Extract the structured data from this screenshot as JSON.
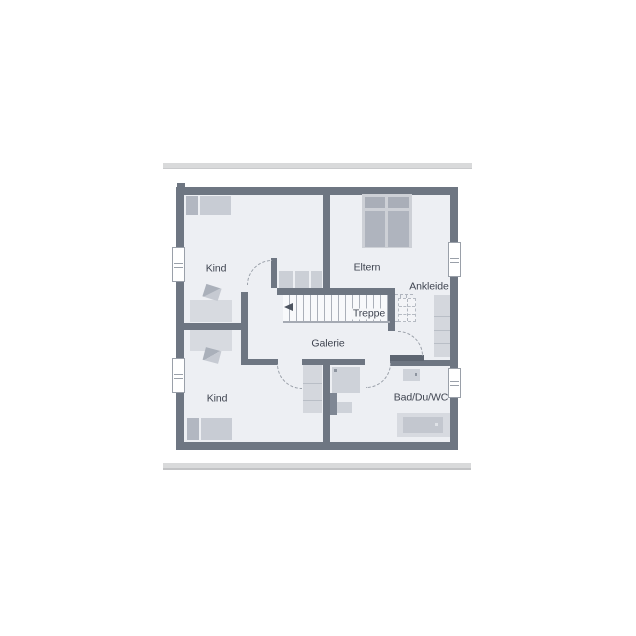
{
  "labels": {
    "kind_top": "Kind",
    "eltern": "Eltern",
    "ankleide": "Ankleide",
    "treppe": "Treppe",
    "galerie": "Galerie",
    "kind_bottom": "Kind",
    "bad": "Bad/Du/WC"
  },
  "colors": {
    "wall": "#6e7682",
    "wall_dark": "#5d6571",
    "floor": "#edeff3",
    "furniture": "#ccd0d7",
    "furniture_light": "#d7dae0",
    "furniture_dark": "#aab0ba",
    "dash_outline": "#9aa0a9",
    "text": "#3f4450",
    "divider_bar": "#d9dadb"
  },
  "icons": {
    "stairs_direction": "left-arrow"
  }
}
